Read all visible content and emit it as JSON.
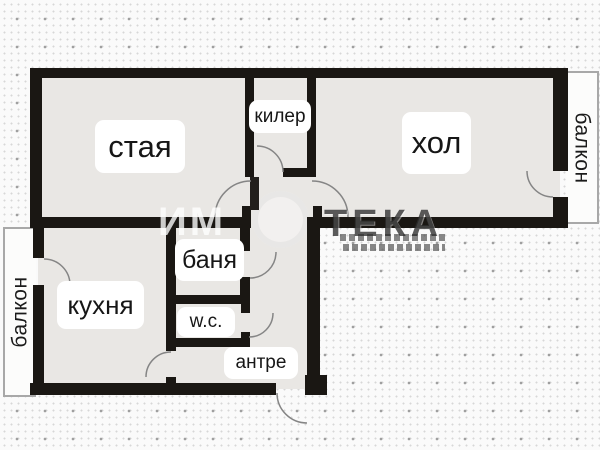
{
  "floorplan": {
    "rooms": [
      {
        "id": "staya",
        "label": "стая"
      },
      {
        "id": "kiler",
        "label": "килер"
      },
      {
        "id": "hol",
        "label": "хол"
      },
      {
        "id": "kuhnya",
        "label": "кухня"
      },
      {
        "id": "banya",
        "label": "баня"
      },
      {
        "id": "wc",
        "label": "w.c."
      },
      {
        "id": "antre",
        "label": "антре"
      },
      {
        "id": "balkon_left",
        "label": "балкон"
      },
      {
        "id": "balkon_right",
        "label": "балкон"
      }
    ],
    "watermark": {
      "prefix": "ИМ",
      "suffix": "ТЕКА"
    },
    "colors": {
      "wall": "#1a1713",
      "floor": "#e9e7e4",
      "outside": "#fafafa",
      "door_line": "#858585",
      "label_bg": "#ffffff",
      "label_text": "#161616",
      "balcony_border": "#a8a8a8"
    }
  }
}
